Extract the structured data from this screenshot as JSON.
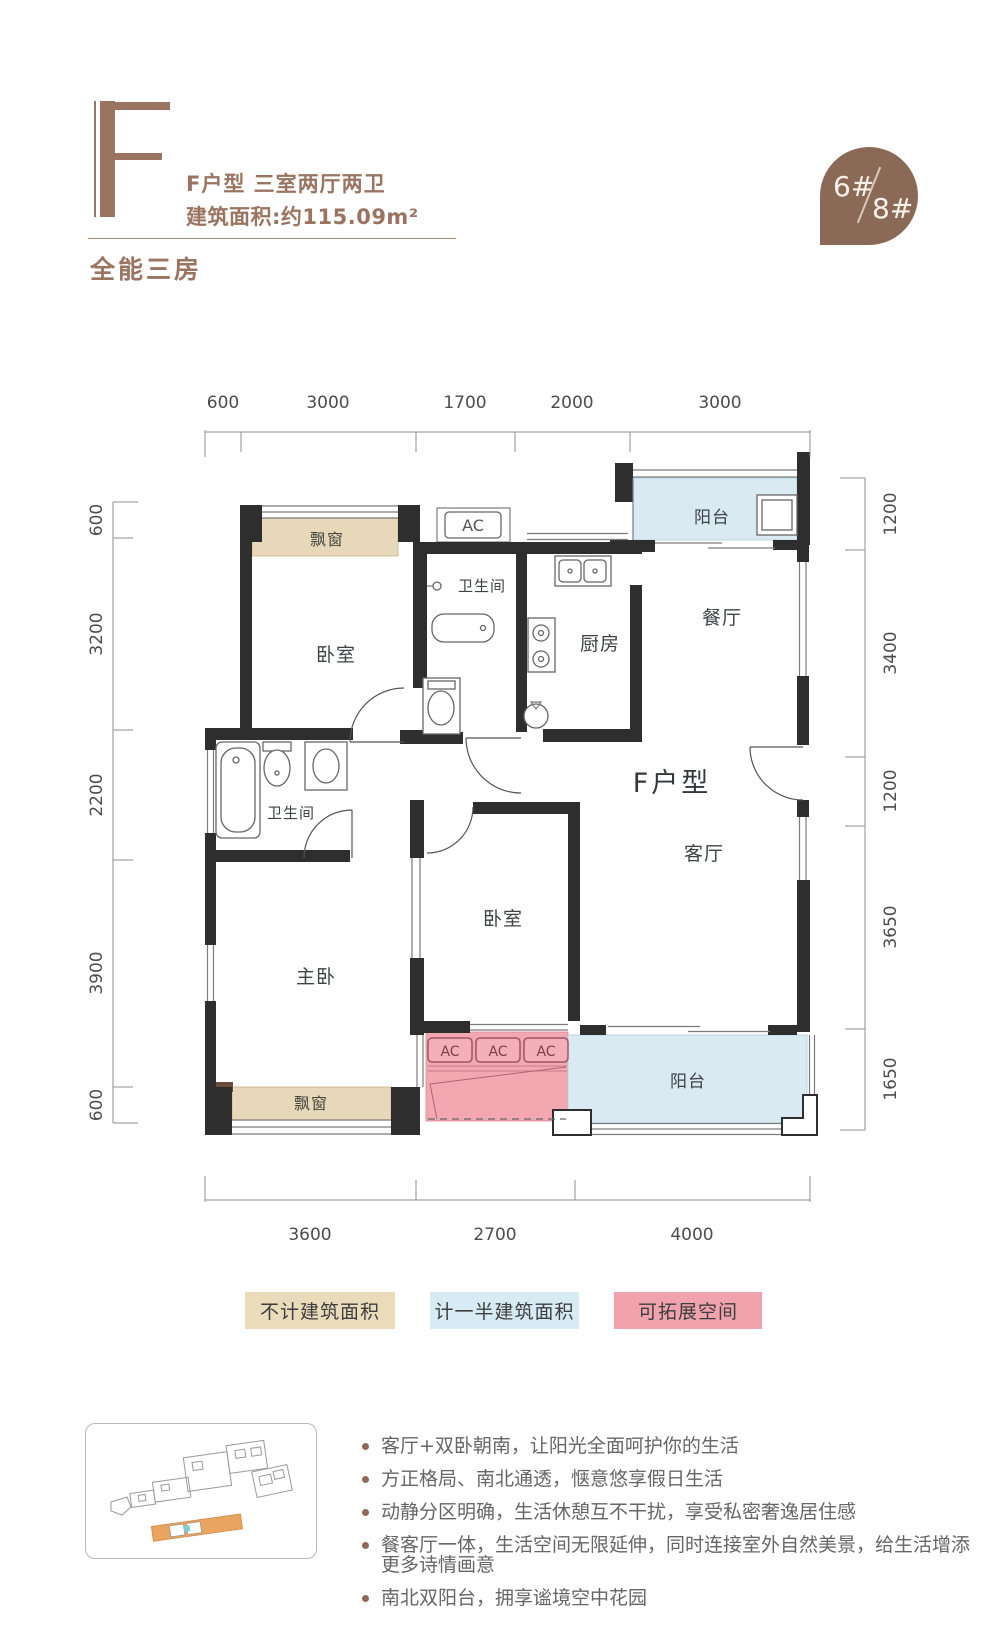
{
  "header": {
    "unit_letter": "F",
    "title_line1": "F户型  三室两厅两卫",
    "title_line2": "建筑面积:约115.09m²",
    "badge_left": "6#",
    "badge_right": "8#",
    "subtitle": "全能三房"
  },
  "plan": {
    "rooms": {
      "bedroom_top": "卧室",
      "bathroom_top": "卫生间",
      "kitchen": "厨房",
      "dining": "餐厅",
      "balcony_north": "阳台",
      "unit_label": "F户型",
      "living": "客厅",
      "bathroom_left": "卫生间",
      "bedroom_middle": "卧室",
      "master_bedroom": "主卧",
      "bay_window_top": "飘窗",
      "bay_window_bottom": "飘窗",
      "balcony_south": "阳台"
    },
    "ac_label": "AC",
    "dimensions": {
      "top": [
        "600",
        "3000",
        "1700",
        "2000",
        "3000"
      ],
      "left": [
        "600",
        "3200",
        "2200",
        "3900",
        "600"
      ],
      "right": [
        "1200",
        "3400",
        "1200",
        "3650",
        "1650"
      ],
      "bottom": [
        "3600",
        "2700",
        "4000"
      ]
    }
  },
  "legend": {
    "items": [
      {
        "label": "不计建筑面积",
        "color": "#EADCBB"
      },
      {
        "label": "计一半建筑面积",
        "color": "#D6EBF4"
      },
      {
        "label": "可拓展空间",
        "color": "#F1A3AD"
      }
    ]
  },
  "features": [
    "客厅+双卧朝南，让阳光全面呵护你的生活",
    "方正格局、南北通透，惬意悠享假日生活",
    "动静分区明确，生活休憩互不干扰，享受私密奢逸居住感",
    "餐客厅一体，生活空间无限延伸，同时连接室外自然美景，给生活增添更多诗情画意",
    "南北双阳台，拥享谧境空中花园"
  ],
  "colors": {
    "accent_brown": "#9A7460",
    "badge_brown": "#8A6A57",
    "wall": "#2E2E2E",
    "bay_beige": "#E7D8B9",
    "balcony_blue": "#D9EAF3",
    "expand_pink": "#F2A7B1"
  }
}
